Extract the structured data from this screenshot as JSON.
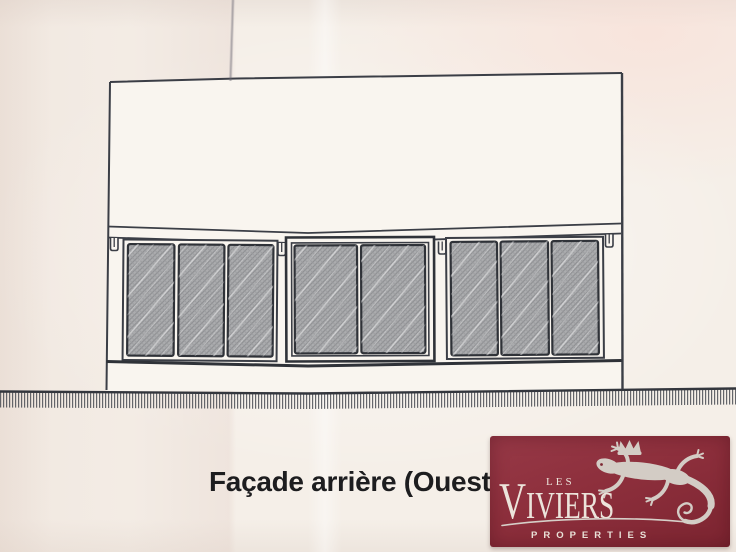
{
  "document": {
    "kind": "scanned architectural elevation drawing",
    "caption": "Façade arrière (Ouest)"
  },
  "drawing": {
    "window_band": {
      "left_group_panes": 3,
      "sliding_door_panes": 2,
      "right_group_panes": 3
    }
  },
  "logo": {
    "les": "LES",
    "viviers": "VIVIERS",
    "properties": "PROPERTIES",
    "background": "#8d2f3c",
    "text_color": "#ece4db",
    "lizard_color": "#d3ccc5"
  },
  "colors": {
    "paper": "#f5efe8",
    "ink": "#3b3e46",
    "glass": "#a5a6a8",
    "caption_text": "#1d1d1f"
  }
}
